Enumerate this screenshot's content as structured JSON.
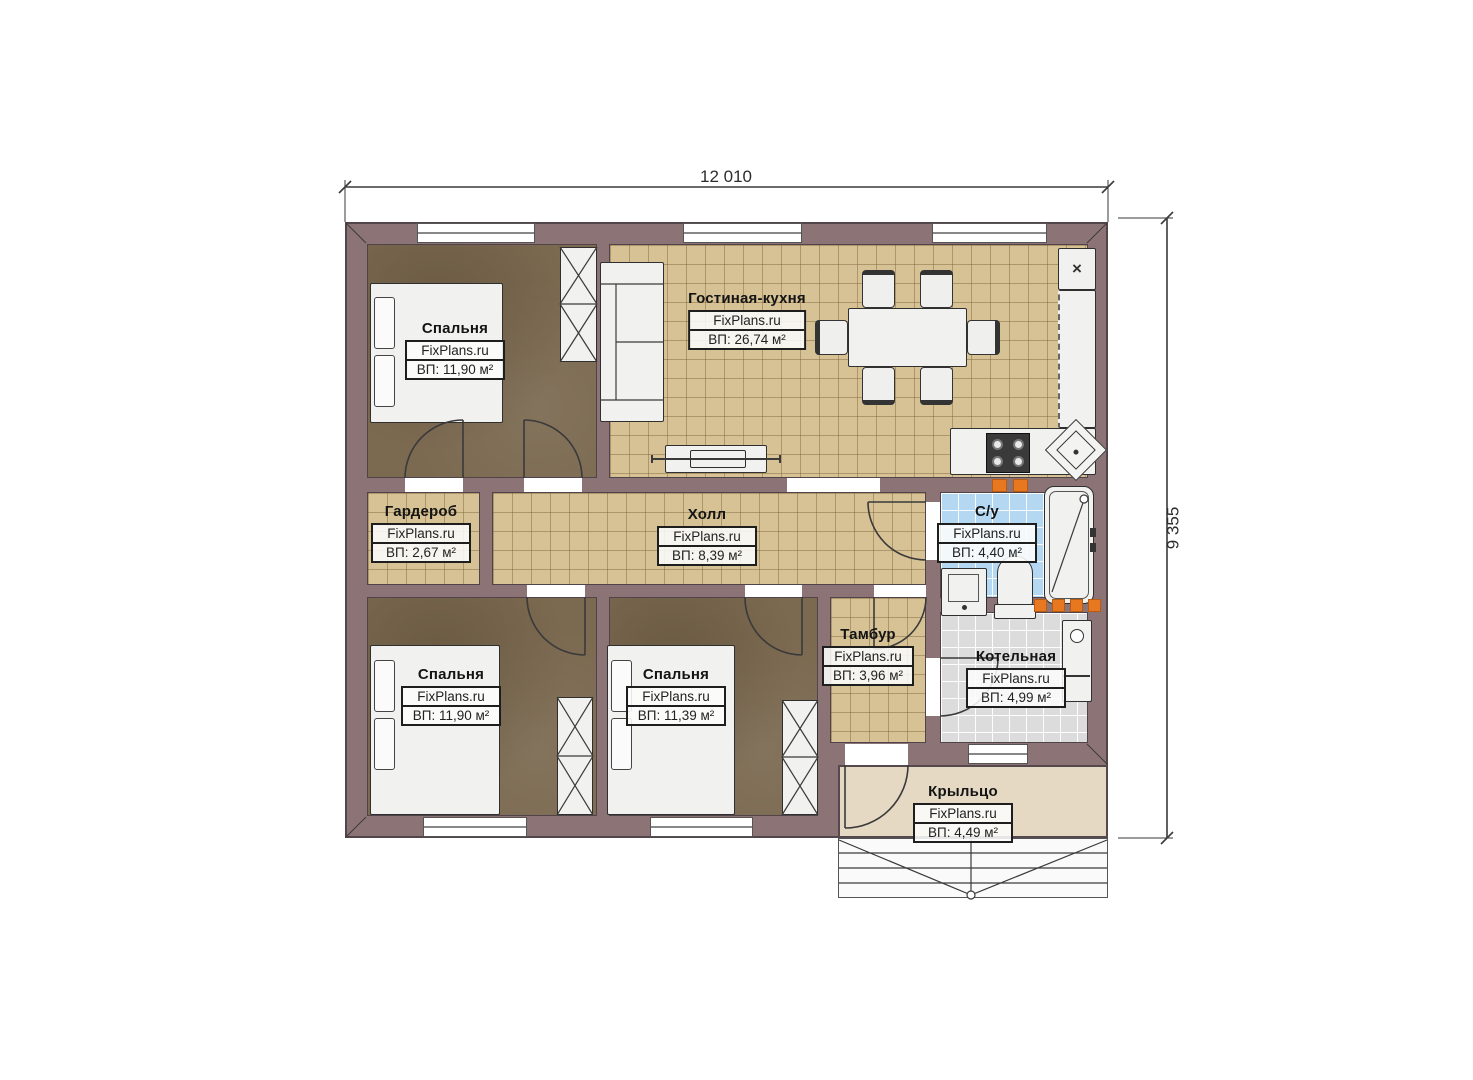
{
  "page": {
    "background": "#ffffff",
    "type": "floor-plan"
  },
  "dimensions": {
    "width_label": "12 010",
    "height_label": "9 355"
  },
  "rooms": [
    {
      "name": "Спальня",
      "watermark": "FixPlans.ru",
      "area": "ВП: 11,90 м²"
    },
    {
      "name": "Гостиная-кухня",
      "watermark": "FixPlans.ru",
      "area": "ВП: 26,74 м²"
    },
    {
      "name": "Гардероб",
      "watermark": "FixPlans.ru",
      "area": "ВП: 2,67 м²"
    },
    {
      "name": "Холл",
      "watermark": "FixPlans.ru",
      "area": "ВП: 8,39 м²"
    },
    {
      "name": "С/у",
      "watermark": "FixPlans.ru",
      "area": "ВП: 4,40 м²"
    },
    {
      "name": "Спальня",
      "watermark": "FixPlans.ru",
      "area": "ВП: 11,90 м²"
    },
    {
      "name": "Спальня",
      "watermark": "FixPlans.ru",
      "area": "ВП: 11,39 м²"
    },
    {
      "name": "Тамбур",
      "watermark": "FixPlans.ru",
      "area": "ВП: 3,96 м²"
    },
    {
      "name": "Котельная",
      "watermark": "FixPlans.ru",
      "area": "ВП: 4,99 м²"
    },
    {
      "name": "Крыльцо",
      "watermark": "FixPlans.ru",
      "area": "ВП: 4,49 м²"
    }
  ],
  "symbols": {
    "fridge_mark": "×"
  },
  "colors": {
    "wall": "#8c7376",
    "bedroom_floor": "#7b6950",
    "tile_floor": "#d6c295",
    "bathroom_floor": "#b5d8f2",
    "boiler_floor": "#dcdcdc",
    "porch_floor": "#e5d9c4",
    "accent_orange": "#e87820"
  }
}
